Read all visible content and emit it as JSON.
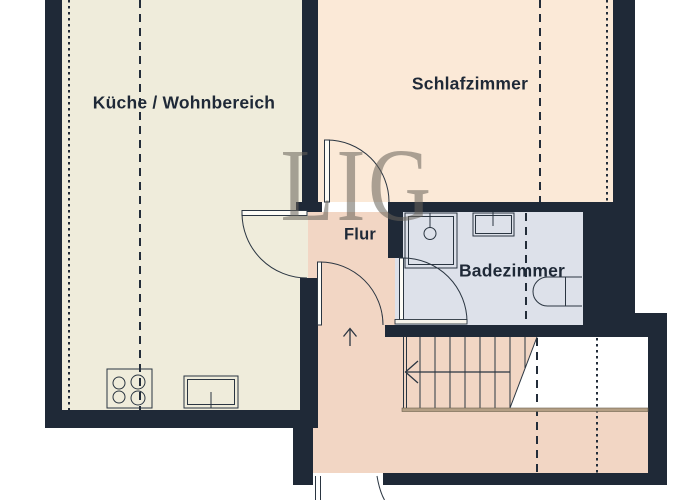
{
  "watermark": {
    "text": "LIG"
  },
  "rooms": {
    "kitchen": {
      "label": "Küche / Wohnbereich"
    },
    "bedroom": {
      "label": "Schlafzimmer"
    },
    "hallway": {
      "label": "Flur"
    },
    "bathroom": {
      "label": "Badezimmer"
    }
  },
  "fixtures": {
    "kitchen": [
      "stove-icon",
      "kitchen-sink-icon"
    ],
    "bathroom": [
      "shower-icon",
      "washbasin-icon",
      "toilet-icon"
    ],
    "stairs": [
      "staircase",
      "stairs-direction-arrow"
    ],
    "hallway": [
      "hallway-up-arrow"
    ]
  },
  "colors": {
    "wall": "#1f2937",
    "kitchen_floor": "#efecdb",
    "bedroom_floor": "#fbe9d7",
    "hallway_floor": "#f2d6c4",
    "bathroom_floor": "#dde1ea",
    "stair_edge": "#b49f85",
    "line": "#2a3541",
    "label": "#1f2937",
    "watermark": "#68635a",
    "background": "#ffffff"
  }
}
